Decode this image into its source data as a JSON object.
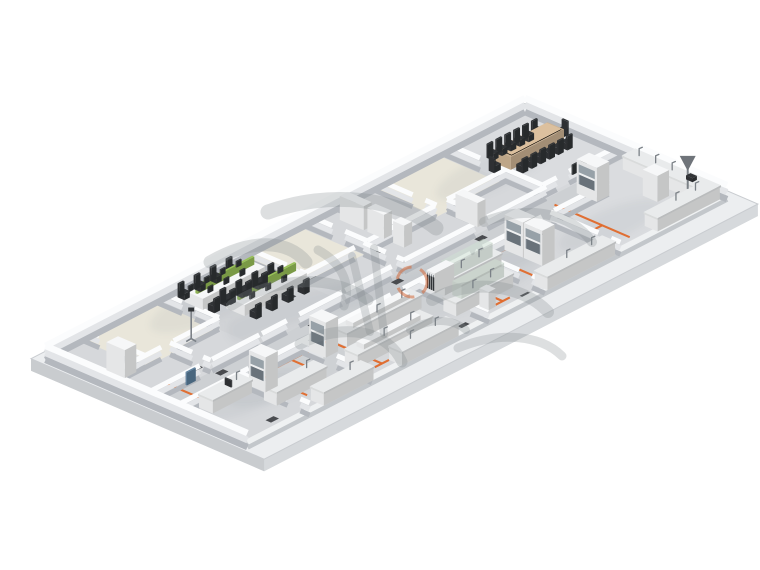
{
  "page": {
    "description": "3D isometric rendering of a laboratory and office floor plan with conference room, open-plan workstations, lab benches, fume hoods and orange floor service lines",
    "background": "#ffffff"
  },
  "watermark": {
    "style": "gray brush calligraphy strokes with orange dashed seal ring",
    "color": "#83888d",
    "accent": "#d4693a"
  },
  "colors": {
    "background": "#ffffff",
    "slab_top": "#eceef0",
    "slab_side": "#d6d9dc",
    "slab_outline": "#c9ccd0",
    "floor": "#d6d8db",
    "floor_conference": "#dadcdf",
    "floor_corridor": "#cdd0d3",
    "floor_beige": "#e9e6da",
    "floor_office": "#d2d4d7",
    "wall_top": "#fbfcfd",
    "wall_mid": "#e3e5e8",
    "wall_base": "#b4b8be",
    "wall_low_top": "#eff1f2",
    "wall_low_base": "#c3c7cb",
    "furniture_white": "#f6f7f8",
    "bench_top": "#e9ebec",
    "wood": "#ccb292",
    "green": "#98c158",
    "dark": "#313437",
    "metal": "#7b8187",
    "glass": "#cfe0d4",
    "hood_window": "#97a1a8",
    "hood_inner": "#69727a",
    "orange": "#e0692a",
    "blue_panel": "#5b7f9e",
    "watermark": "#83888d",
    "watermark_accent": "#d4693a",
    "shadow": "#8d939a"
  }
}
